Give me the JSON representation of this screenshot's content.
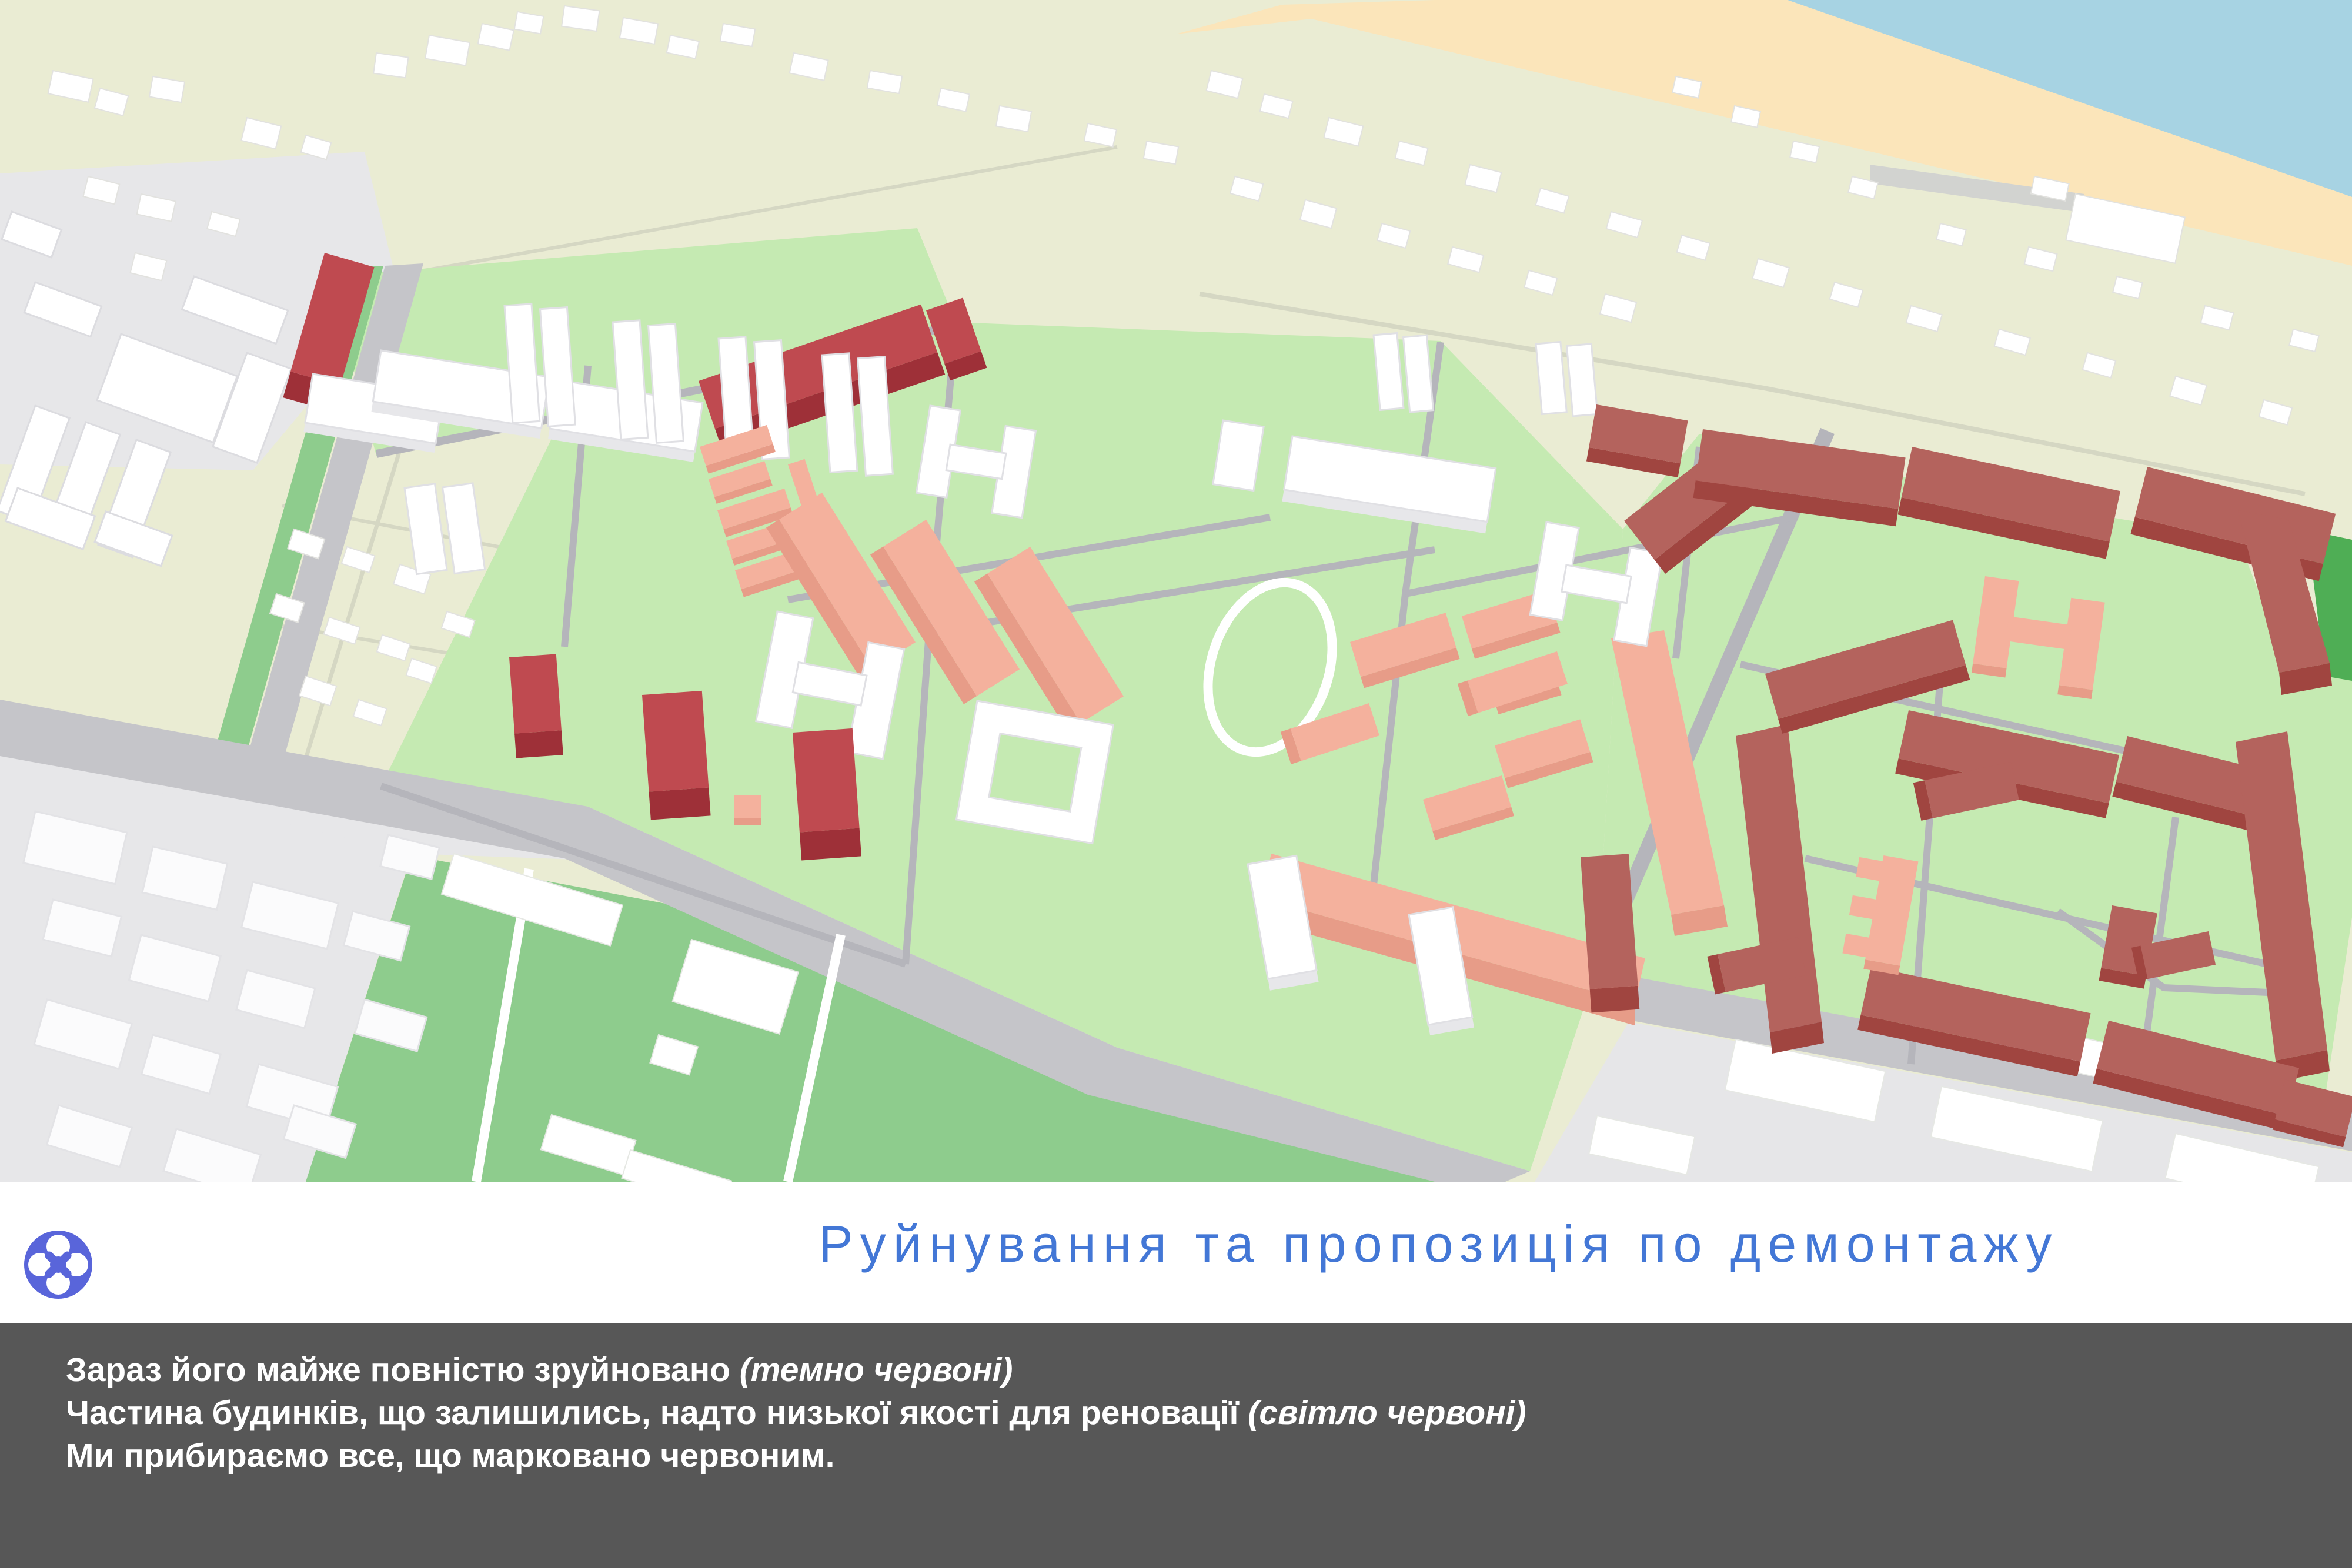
{
  "slide": {
    "title": "Руйнування та пропозиція по демонтажу",
    "footer": {
      "line1_main": "Зараз його майже повністю зруйновано ",
      "line1_note": "(темно червоні)",
      "line2_main": "Частина будинків, що залишились, надто низької якості для реновації ",
      "line2_note": "(світло червоні)",
      "line3_main": "Ми прибираємо все, що марковано червоним."
    }
  },
  "icons": {
    "logo": "four-petal-clover-knot-icon"
  },
  "map": {
    "type": "3d-masterplan",
    "features": {
      "water": "sea top-right",
      "beach": "sand strip along shore",
      "cottage_band": "pale low-rise private housing along coast",
      "districts": "light green residential districts",
      "field": "large green field bottom-center",
      "industrial": "gray industrial zone bottom-left",
      "dark_red_buildings": "destroyed buildings",
      "light_red_buildings": "low quality buildings",
      "white_buildings": "retained buildings"
    }
  },
  "colors": {
    "land_pale": "#eaecd3",
    "water_blue": "#a7d3e3",
    "beach_sand": "#fbe5ba",
    "district_green": "#c5eab2",
    "strip_green": "#8ecc8d",
    "field_green": "#8ecc8d",
    "sports_green": "#4fae55",
    "road_gray": "#c5c5c9",
    "road_thin": "#b5b5bb",
    "path_pale": "#d5d7c3",
    "area_gray": "#e7e7e9",
    "white_top": "#ffffff",
    "white_side": "#e7e7ea",
    "salmon_top": "#f4b19d",
    "salmon_side": "#e79c88",
    "red_bright_top": "#bf4a50",
    "red_bright_side": "#9e3038",
    "red_muted_top": "#b4635d",
    "red_muted_side": "#a04540",
    "title_blue": "#4377d6",
    "footer_bg": "#575757",
    "footer_text": "#ffffff",
    "logo_blue": "#5965da"
  }
}
